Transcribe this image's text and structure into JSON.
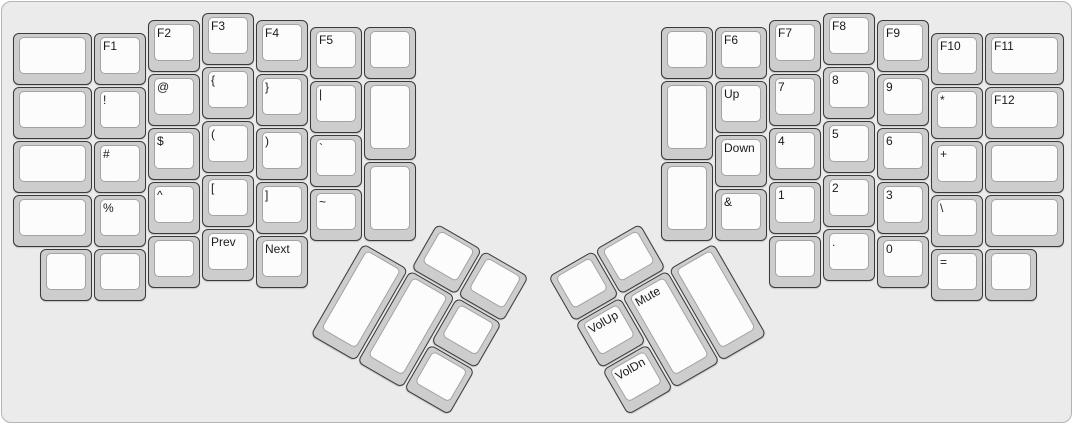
{
  "canvas": {
    "colors": {
      "bg": "#ebebeb",
      "boardborder": "#b3b3b3",
      "cap": "#cdcdcd",
      "captop": "#fcfcfc",
      "capborder": "#3a3a3a",
      "topborder": "#a3a3a3",
      "label": "#1a1a1a"
    }
  },
  "keyboard": {
    "unit_px": 54,
    "groups": [
      {
        "id": "left-main",
        "x": 0,
        "y": 0,
        "rotation": 0,
        "origin": "0px 0px",
        "keys": [
          {
            "x": 10,
            "y": 30.25,
            "w": 81,
            "h": 54
          },
          {
            "x": 10,
            "y": 84.25,
            "w": 81,
            "h": 54
          },
          {
            "x": 10,
            "y": 138.25,
            "w": 81,
            "h": 54
          },
          {
            "x": 10,
            "y": 192.25,
            "w": 81,
            "h": 54
          },
          {
            "x": 37,
            "y": 246.25,
            "w": 54,
            "h": 54
          },
          {
            "x": 91,
            "y": 30.25,
            "w": 54,
            "h": 54,
            "label": "F1",
            "name": "f1"
          },
          {
            "x": 91,
            "y": 84.25,
            "w": 54,
            "h": 54,
            "label": "!",
            "name": "exclamation"
          },
          {
            "x": 91,
            "y": 138.25,
            "w": 54,
            "h": 54,
            "label": "#",
            "name": "hash"
          },
          {
            "x": 91,
            "y": 192.25,
            "w": 54,
            "h": 54,
            "label": "%",
            "name": "percent"
          },
          {
            "x": 91,
            "y": 246.25,
            "w": 54,
            "h": 54
          },
          {
            "x": 145,
            "y": 16.75,
            "w": 54,
            "h": 54,
            "label": "F2",
            "name": "f2"
          },
          {
            "x": 145,
            "y": 70.75,
            "w": 54,
            "h": 54,
            "label": "@",
            "name": "at"
          },
          {
            "x": 145,
            "y": 124.75,
            "w": 54,
            "h": 54,
            "label": "$",
            "name": "dollar"
          },
          {
            "x": 145,
            "y": 178.75,
            "w": 54,
            "h": 54,
            "label": "^",
            "name": "caret"
          },
          {
            "x": 145,
            "y": 232.75,
            "w": 54,
            "h": 54
          },
          {
            "x": 199,
            "y": 10,
            "w": 54,
            "h": 54,
            "label": "F3",
            "name": "f3"
          },
          {
            "x": 199,
            "y": 64,
            "w": 54,
            "h": 54,
            "label": "{",
            "name": "brace-open"
          },
          {
            "x": 199,
            "y": 118,
            "w": 54,
            "h": 54,
            "label": "(",
            "name": "paren-open"
          },
          {
            "x": 199,
            "y": 172,
            "w": 54,
            "h": 54,
            "label": "[",
            "name": "bracket-open"
          },
          {
            "x": 199,
            "y": 226,
            "w": 54,
            "h": 54,
            "label": "Prev",
            "name": "prev"
          },
          {
            "x": 253,
            "y": 16.75,
            "w": 54,
            "h": 54,
            "label": "F4",
            "name": "f4"
          },
          {
            "x": 253,
            "y": 70.75,
            "w": 54,
            "h": 54,
            "label": "}",
            "name": "brace-close"
          },
          {
            "x": 253,
            "y": 124.75,
            "w": 54,
            "h": 54,
            "label": ")",
            "name": "paren-close"
          },
          {
            "x": 253,
            "y": 178.75,
            "w": 54,
            "h": 54,
            "label": "]",
            "name": "bracket-close"
          },
          {
            "x": 253,
            "y": 232.75,
            "w": 54,
            "h": 54,
            "label": "Next",
            "name": "next"
          },
          {
            "x": 307,
            "y": 23.5,
            "w": 54,
            "h": 54,
            "label": "F5",
            "name": "f5"
          },
          {
            "x": 307,
            "y": 77.5,
            "w": 54,
            "h": 54,
            "label": "|",
            "name": "pipe"
          },
          {
            "x": 307,
            "y": 131.5,
            "w": 54,
            "h": 54,
            "label": "`",
            "name": "backtick"
          },
          {
            "x": 307,
            "y": 185.5,
            "w": 54,
            "h": 54,
            "label": "~",
            "name": "tilde"
          },
          {
            "x": 361,
            "y": 23.5,
            "w": 54,
            "h": 54
          },
          {
            "x": 361,
            "y": 77.5,
            "w": 54,
            "h": 81
          },
          {
            "x": 361,
            "y": 158.5,
            "w": 54,
            "h": 81
          }
        ]
      },
      {
        "id": "right-main",
        "x": 0,
        "y": 0,
        "rotation": 0,
        "origin": "0px 0px",
        "keys": [
          {
            "x": 658,
            "y": 23.5,
            "w": 54,
            "h": 54
          },
          {
            "x": 658,
            "y": 77.5,
            "w": 54,
            "h": 81
          },
          {
            "x": 658,
            "y": 158.5,
            "w": 54,
            "h": 81
          },
          {
            "x": 712,
            "y": 23.5,
            "w": 54,
            "h": 54,
            "label": "F6",
            "name": "f6"
          },
          {
            "x": 712,
            "y": 77.5,
            "w": 54,
            "h": 54,
            "label": "Up",
            "name": "up"
          },
          {
            "x": 712,
            "y": 131.5,
            "w": 54,
            "h": 54,
            "label": "Down",
            "name": "down"
          },
          {
            "x": 712,
            "y": 185.5,
            "w": 54,
            "h": 54,
            "label": "&",
            "name": "ampersand"
          },
          {
            "x": 766,
            "y": 16.75,
            "w": 54,
            "h": 54,
            "label": "F7",
            "name": "f7"
          },
          {
            "x": 766,
            "y": 70.75,
            "w": 54,
            "h": 54,
            "label": "7",
            "name": "digit-7"
          },
          {
            "x": 766,
            "y": 124.75,
            "w": 54,
            "h": 54,
            "label": "4",
            "name": "digit-4"
          },
          {
            "x": 766,
            "y": 178.75,
            "w": 54,
            "h": 54,
            "label": "1",
            "name": "digit-1"
          },
          {
            "x": 766,
            "y": 232.75,
            "w": 54,
            "h": 54
          },
          {
            "x": 820,
            "y": 10,
            "w": 54,
            "h": 54,
            "label": "F8",
            "name": "f8"
          },
          {
            "x": 820,
            "y": 64,
            "w": 54,
            "h": 54,
            "label": "8",
            "name": "digit-8"
          },
          {
            "x": 820,
            "y": 118,
            "w": 54,
            "h": 54,
            "label": "5",
            "name": "digit-5"
          },
          {
            "x": 820,
            "y": 172,
            "w": 54,
            "h": 54,
            "label": "2",
            "name": "digit-2"
          },
          {
            "x": 820,
            "y": 226,
            "w": 54,
            "h": 54,
            "label": ".",
            "name": "period"
          },
          {
            "x": 874,
            "y": 16.75,
            "w": 54,
            "h": 54,
            "label": "F9",
            "name": "f9"
          },
          {
            "x": 874,
            "y": 70.75,
            "w": 54,
            "h": 54,
            "label": "9",
            "name": "digit-9"
          },
          {
            "x": 874,
            "y": 124.75,
            "w": 54,
            "h": 54,
            "label": "6",
            "name": "digit-6"
          },
          {
            "x": 874,
            "y": 178.75,
            "w": 54,
            "h": 54,
            "label": "3",
            "name": "digit-3"
          },
          {
            "x": 874,
            "y": 232.75,
            "w": 54,
            "h": 54,
            "label": "0",
            "name": "digit-0"
          },
          {
            "x": 928,
            "y": 30.25,
            "w": 54,
            "h": 54,
            "label": "F10",
            "name": "f10"
          },
          {
            "x": 928,
            "y": 84.25,
            "w": 54,
            "h": 54,
            "label": "*",
            "name": "asterisk"
          },
          {
            "x": 928,
            "y": 138.25,
            "w": 54,
            "h": 54,
            "label": "+",
            "name": "plus"
          },
          {
            "x": 928,
            "y": 192.25,
            "w": 54,
            "h": 54,
            "label": "\\",
            "name": "backslash"
          },
          {
            "x": 928,
            "y": 246.25,
            "w": 54,
            "h": 54,
            "label": "=",
            "name": "equals"
          },
          {
            "x": 982,
            "y": 30.25,
            "w": 81,
            "h": 54,
            "label": "F11",
            "name": "f11"
          },
          {
            "x": 982,
            "y": 84.25,
            "w": 81,
            "h": 54,
            "label": "F12",
            "name": "f12"
          },
          {
            "x": 982,
            "y": 138.25,
            "w": 81,
            "h": 54
          },
          {
            "x": 982,
            "y": 192.25,
            "w": 81,
            "h": 54
          },
          {
            "x": 982,
            "y": 246.25,
            "w": 54,
            "h": 54
          }
        ]
      },
      {
        "id": "left-thumb",
        "x": 361,
        "y": 185.5,
        "rotation": 30,
        "origin": "0px 54px",
        "keys": [
          {
            "x": 54,
            "y": 0,
            "w": 54,
            "h": 54
          },
          {
            "x": 108,
            "y": 0,
            "w": 54,
            "h": 54
          },
          {
            "x": 0,
            "y": 54,
            "w": 54,
            "h": 108
          },
          {
            "x": 54,
            "y": 54,
            "w": 54,
            "h": 108
          },
          {
            "x": 108,
            "y": 54,
            "w": 54,
            "h": 54
          },
          {
            "x": 108,
            "y": 108,
            "w": 54,
            "h": 54
          }
        ]
      },
      {
        "id": "right-thumb",
        "x": 550,
        "y": 185.5,
        "rotation": -30,
        "origin": "162px 54px",
        "keys": [
          {
            "x": 0,
            "y": 0,
            "w": 54,
            "h": 54
          },
          {
            "x": 54,
            "y": 0,
            "w": 54,
            "h": 54
          },
          {
            "x": 0,
            "y": 54,
            "w": 54,
            "h": 54,
            "label": "VolUp",
            "name": "volume-up"
          },
          {
            "x": 0,
            "y": 108,
            "w": 54,
            "h": 54,
            "label": "VolDn",
            "name": "volume-down"
          },
          {
            "x": 54,
            "y": 54,
            "w": 54,
            "h": 108,
            "label": "Mute",
            "name": "mute"
          },
          {
            "x": 108,
            "y": 54,
            "w": 54,
            "h": 108
          }
        ]
      }
    ]
  }
}
